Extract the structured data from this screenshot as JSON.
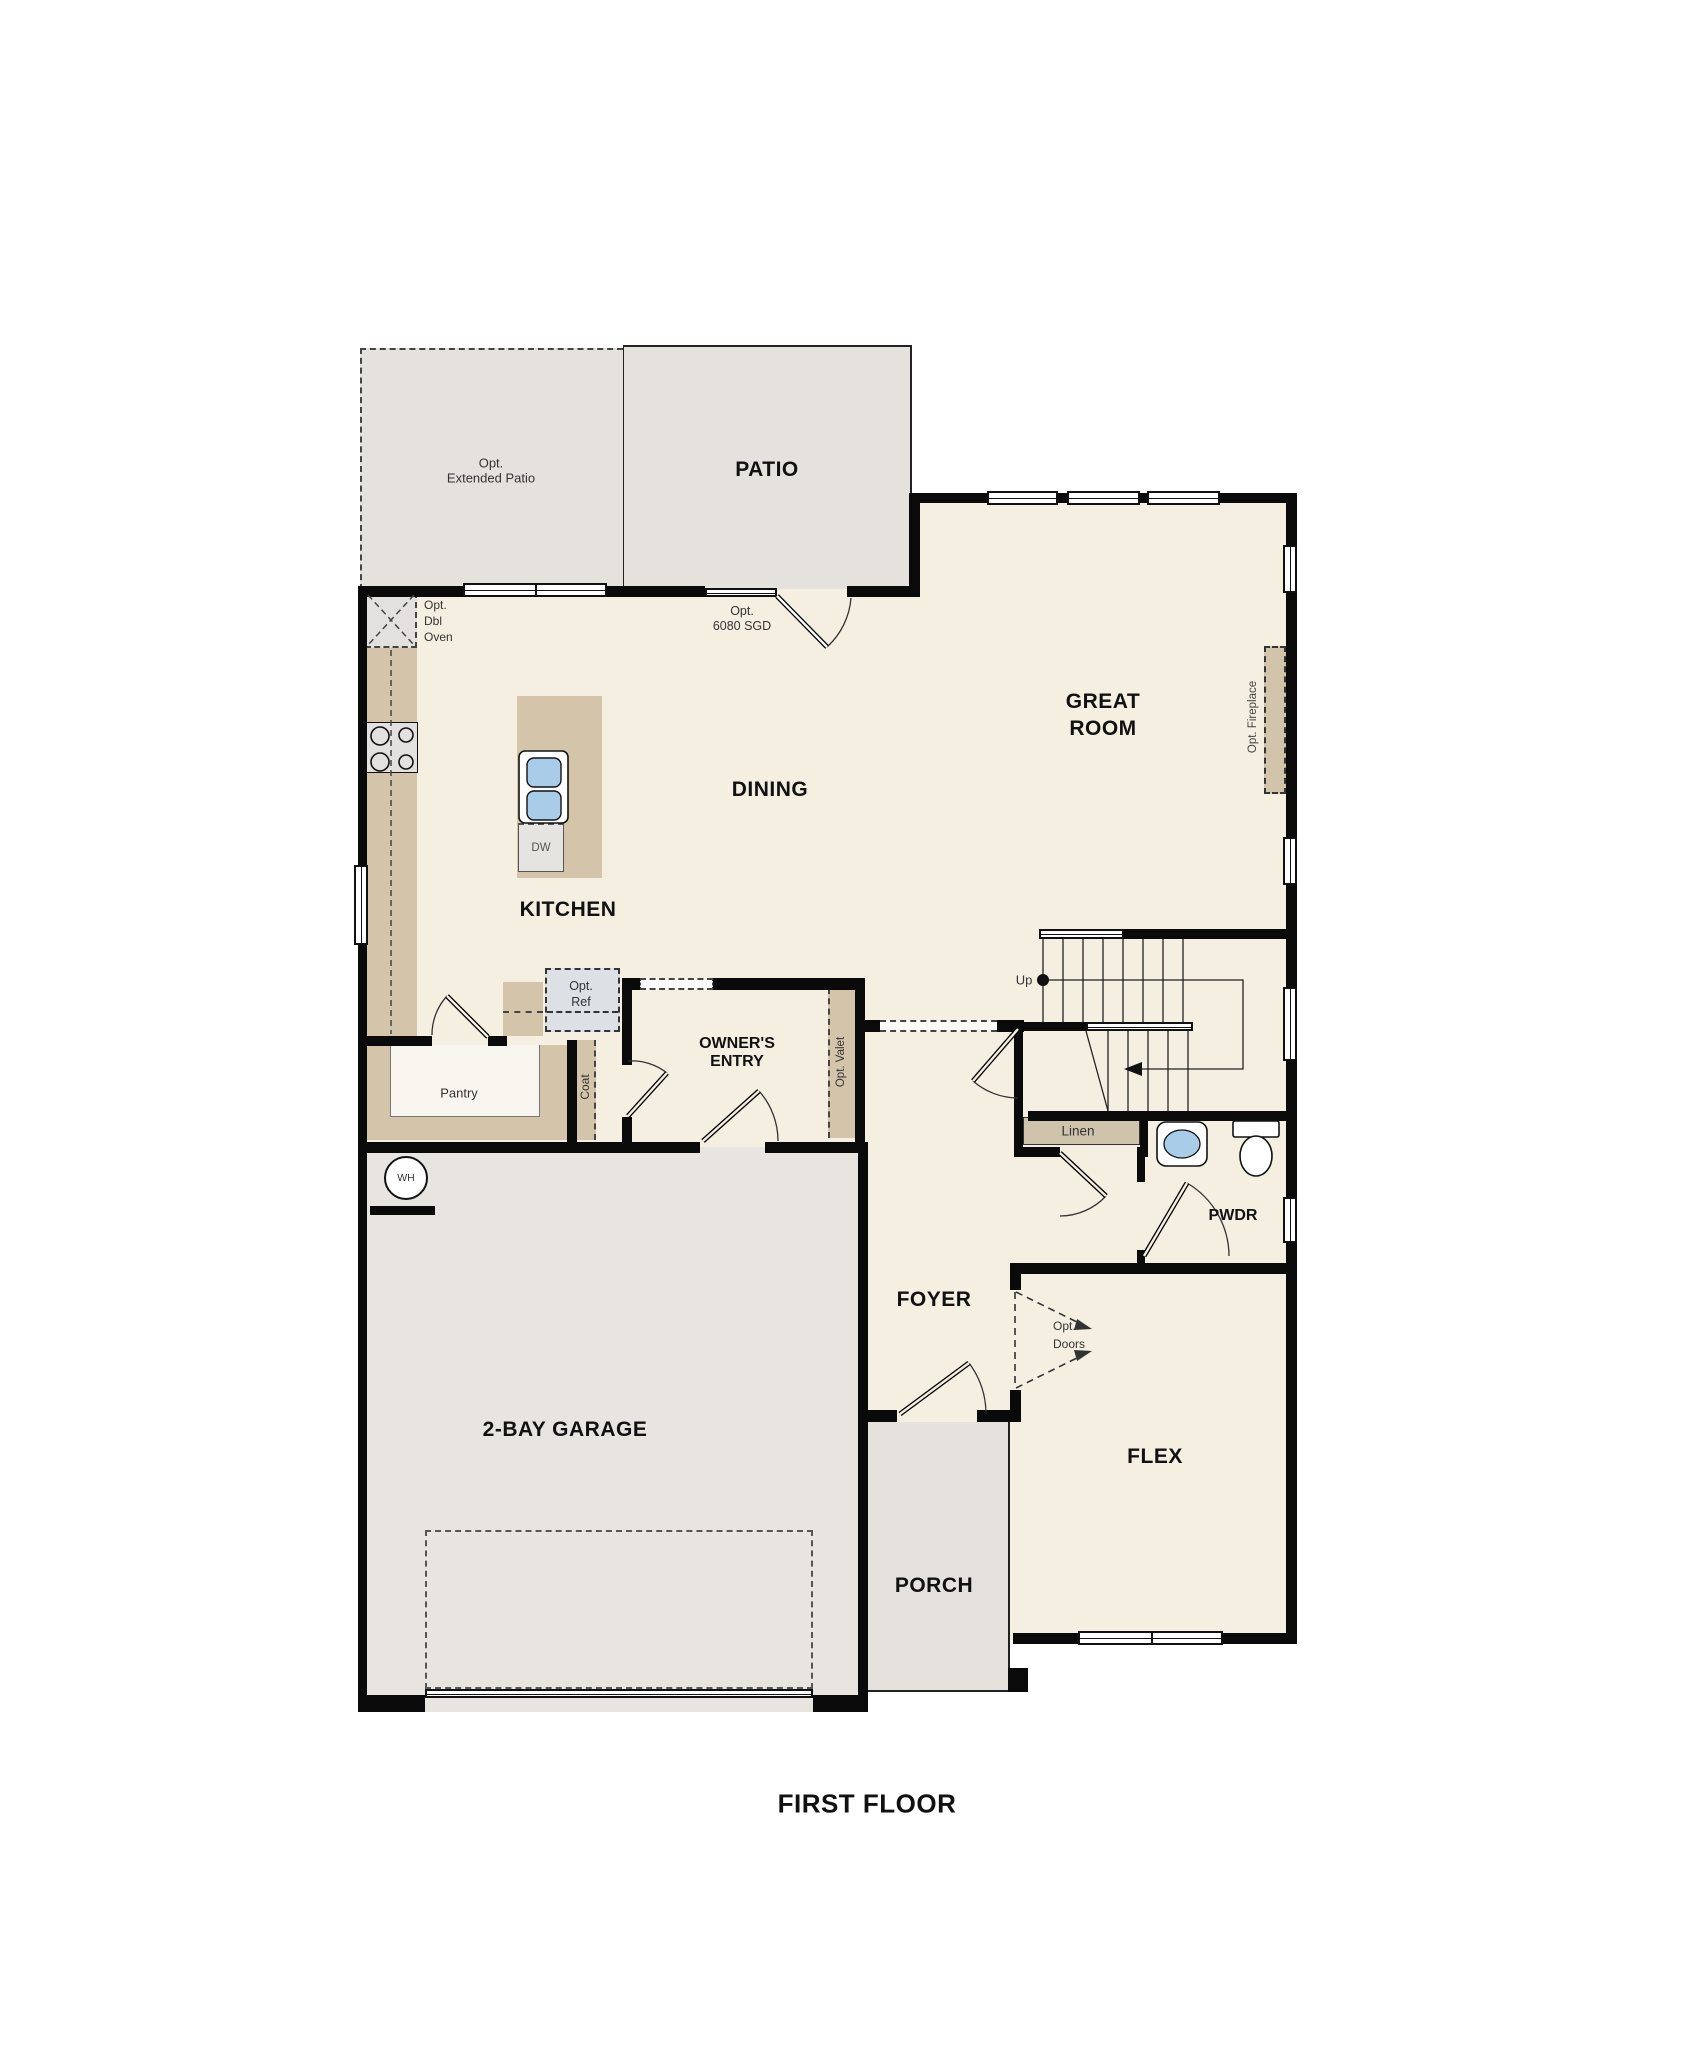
{
  "title": "FIRST FLOOR",
  "colors": {
    "wall": "#0a0a0a",
    "floor": "#f5efe2",
    "outdoor": "#e5e2dd",
    "garage_floor": "#e8e5e1",
    "counter_tan": "#d4c5aa",
    "appliance_grey": "#e3e1df",
    "fridge_grey": "#dde0e4",
    "sink_blue": "#a9cde9"
  },
  "rooms": {
    "patio": "PATIO",
    "ext_patio_line1": "Opt.",
    "ext_patio_line2": "Extended Patio",
    "great_room_line1": "GREAT",
    "great_room_line2": "ROOM",
    "dining": "DINING",
    "kitchen": "KITCHEN",
    "owners_entry_line1": "OWNER'S",
    "owners_entry_line2": "ENTRY",
    "pantry": "Pantry",
    "coat": "Coat",
    "foyer": "FOYER",
    "pwdr": "PWDR",
    "linen": "Linen",
    "flex": "FLEX",
    "porch": "PORCH",
    "garage": "2-BAY GARAGE",
    "stairs_up": "Up"
  },
  "fixtures": {
    "dw": "DW",
    "wh": "WH",
    "opt_ref_line1": "Opt.",
    "opt_ref_line2": "Ref",
    "opt_dbl_oven_line1": "Opt.",
    "opt_dbl_oven_line2": "Dbl",
    "opt_dbl_oven_line3": "Oven",
    "opt_valet": "Opt. Valet",
    "opt_fireplace": "Opt. Fireplace",
    "sgd_line1": "Opt.",
    "sgd_line2": "6080 SGD",
    "opt_doors_line1": "Opt.",
    "opt_doors_line2": "Doors"
  }
}
